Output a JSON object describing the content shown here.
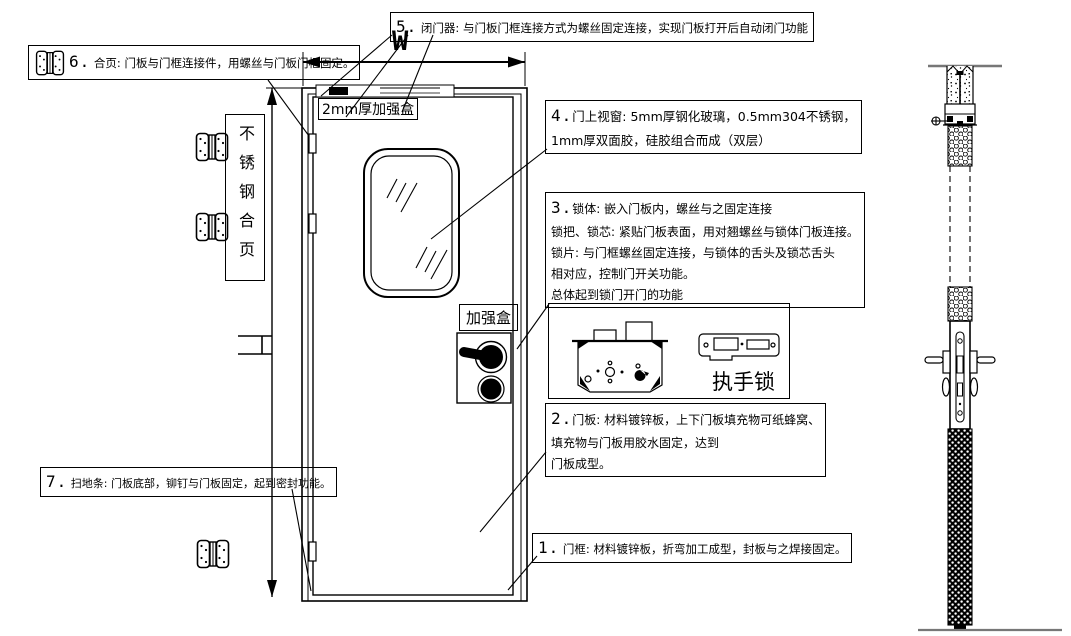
{
  "drawing": {
    "callout1": {
      "num": "1.",
      "text": "门框: 材料镀锌板，折弯加工成型，封板与之焊接固定。"
    },
    "callout2": {
      "num": "2.",
      "lines": [
        "门板: 材料镀锌板，上下门板填充物可纸蜂窝、",
        "填充物与门板用胶水固定，达到",
        "门板成型。"
      ]
    },
    "callout3": {
      "num": "3.",
      "lines": [
        "锁体: 嵌入门板内，螺丝与之固定连接",
        "锁把、锁芯: 紧贴门板表面，用对翘螺丝与锁体门板连接。",
        "锁片: 与门框螺丝固定连接，与锁体的舌头及锁芯舌头",
        "相对应，控制门开关功能。",
        "总体起到锁门开门的功能"
      ]
    },
    "callout4": {
      "num": "4.",
      "lines": [
        "门上视窗: 5mm厚钢化玻璃，0.5mm304不锈钢，",
        "1mm厚双面胶，硅胶组合而成（双层）"
      ]
    },
    "callout5": {
      "num": "5.",
      "text": "闭门器: 与门板门框连接方式为螺丝固定连接，实现门板打开后自动闭门功能"
    },
    "callout6": {
      "num": "6.",
      "text": "合页: 门板与门框连接件，用螺丝与门板门框固定。"
    },
    "callout7": {
      "num": "7.",
      "text": "扫地条: 门板底部，铆钉与门板固定，起到密封功能。"
    },
    "labels": {
      "width_dimension": "W",
      "top_reinforce_box": "2mm厚加强盒",
      "lock_reinforce_box": "加强盒",
      "stainless_hinge": "不锈钢合页",
      "handle_lock": "执手锁"
    },
    "colors": {
      "line": "#000000",
      "ground": "#777777"
    }
  }
}
